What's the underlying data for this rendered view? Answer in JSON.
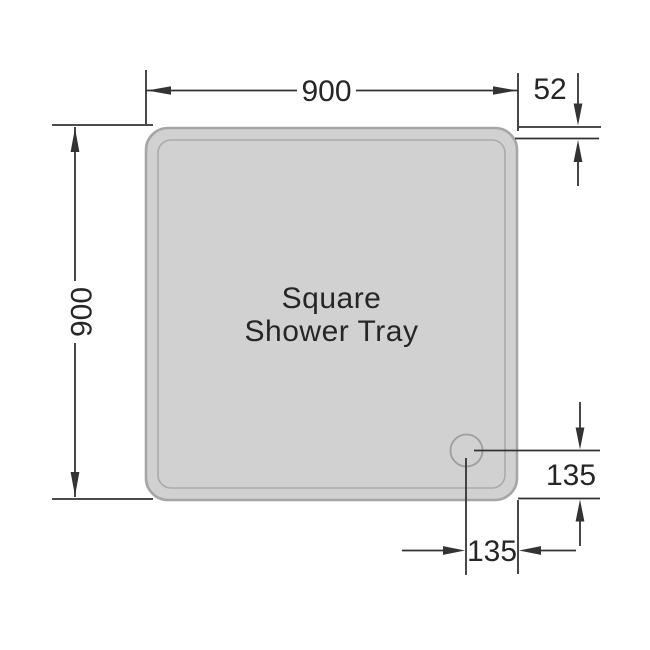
{
  "title": {
    "line1": "Square",
    "line2": "Shower Tray"
  },
  "dimensions": {
    "width": {
      "label": "900"
    },
    "height": {
      "label": "900"
    },
    "depth": {
      "label": "52"
    },
    "drain_from_right": {
      "label": "135"
    },
    "drain_from_bottom": {
      "label": "135"
    }
  },
  "colors": {
    "background": "#ffffff",
    "tray_fill": "#d1d1d1",
    "tray_stroke": "#a6a6a6",
    "tray_rim_stroke": "#aaaaaa",
    "drain_stroke": "#9e9e9e",
    "line_color": "#333333",
    "text_color": "#262626"
  }
}
